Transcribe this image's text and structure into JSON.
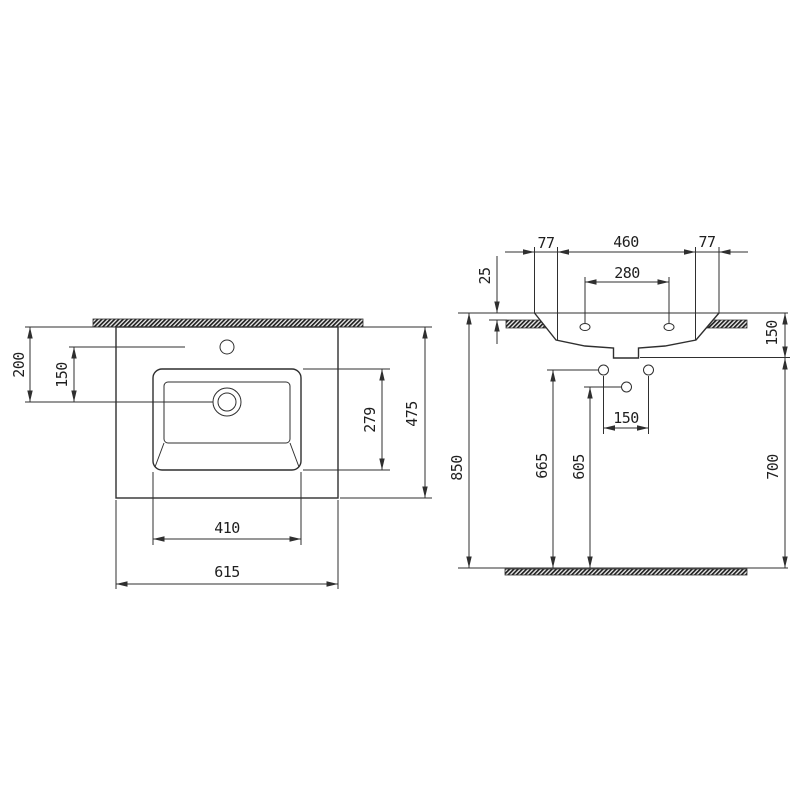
{
  "drawing": {
    "type": "technical-dimension-drawing",
    "subject": "wall-hung washbasin, plan view and front elevation",
    "colors": {
      "background": "#ffffff",
      "line": "#2f2f2f",
      "hatch": "#1f1f1f",
      "text": "#1f1f1f"
    },
    "plan": {
      "d200": "200",
      "d150": "150",
      "d279": "279",
      "d475": "475",
      "d410": "410",
      "d615": "615"
    },
    "elevation": {
      "d77_left": "77",
      "d460": "460",
      "d77_right": "77",
      "d25": "25",
      "d280": "280",
      "d150_rim": "150",
      "d850": "850",
      "d665": "665",
      "d605": "605",
      "d150_holes": "150",
      "d700": "700"
    }
  }
}
